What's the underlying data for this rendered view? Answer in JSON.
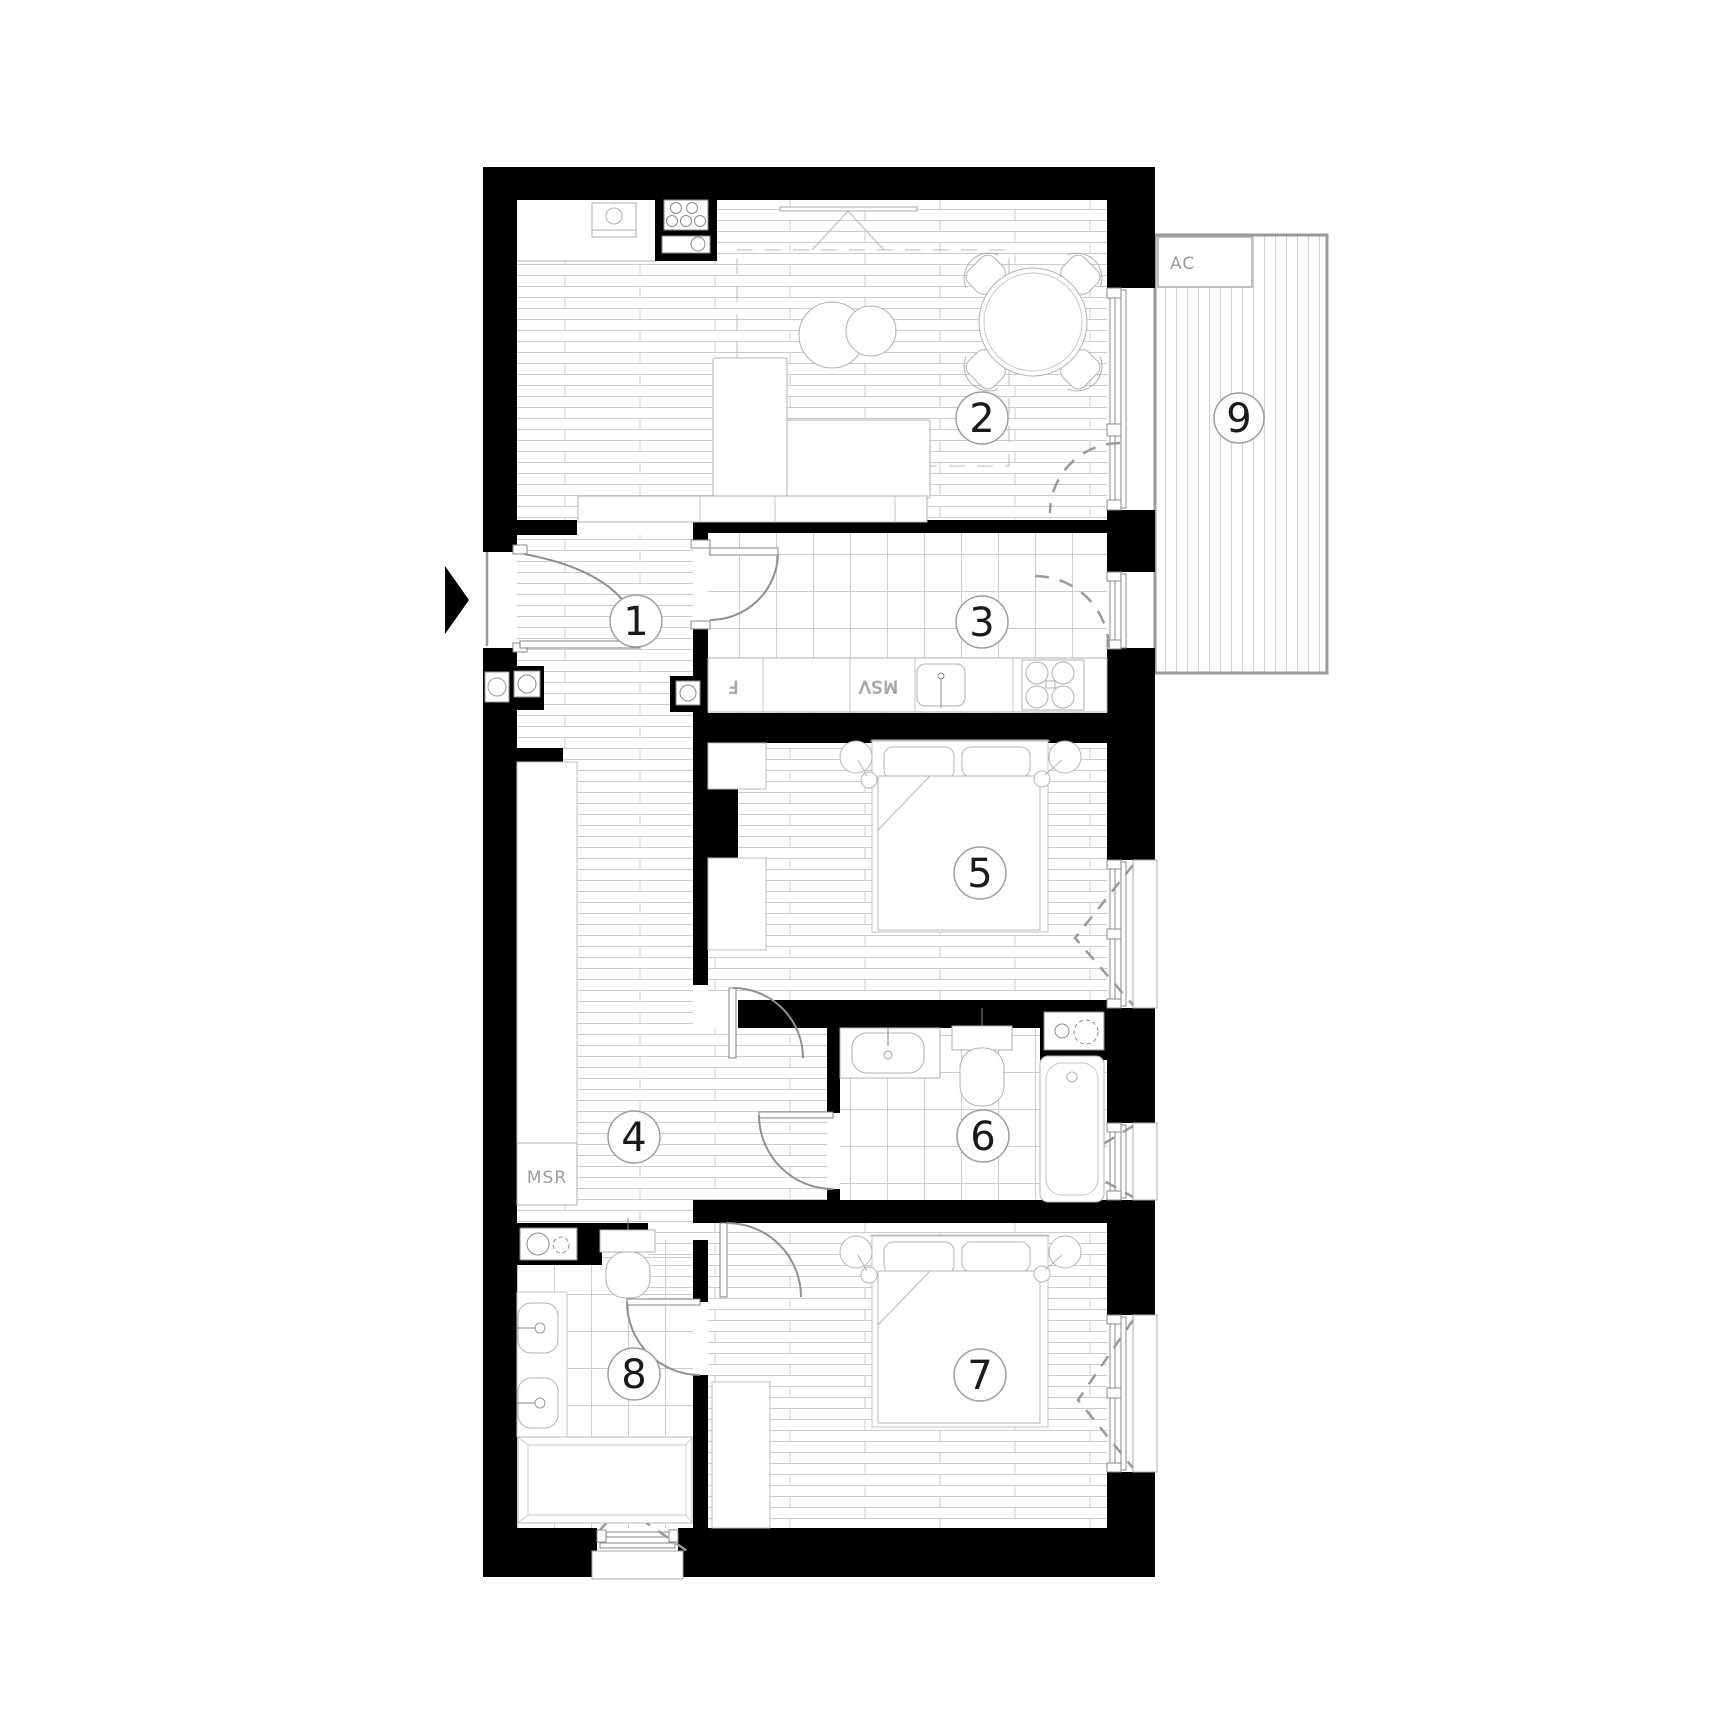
{
  "floor_plan": {
    "rooms": [
      {
        "id": 1,
        "label": "1"
      },
      {
        "id": 2,
        "label": "2"
      },
      {
        "id": 3,
        "label": "3"
      },
      {
        "id": 4,
        "label": "4"
      },
      {
        "id": 5,
        "label": "5"
      },
      {
        "id": 6,
        "label": "6"
      },
      {
        "id": 7,
        "label": "7"
      },
      {
        "id": 8,
        "label": "8"
      },
      {
        "id": 9,
        "label": "9"
      }
    ],
    "annotations": {
      "ac_unit": "AC",
      "meter_riser": "MSR",
      "msv": "MSV",
      "fridge": "F"
    },
    "colors": {
      "wall": "#000000",
      "floor_line": "#cccccc",
      "furniture_line": "#b0b0b0",
      "frame_line": "#8a8a8a",
      "label_text": "#9b9b9b",
      "number_text": "#1a1a1a"
    }
  }
}
